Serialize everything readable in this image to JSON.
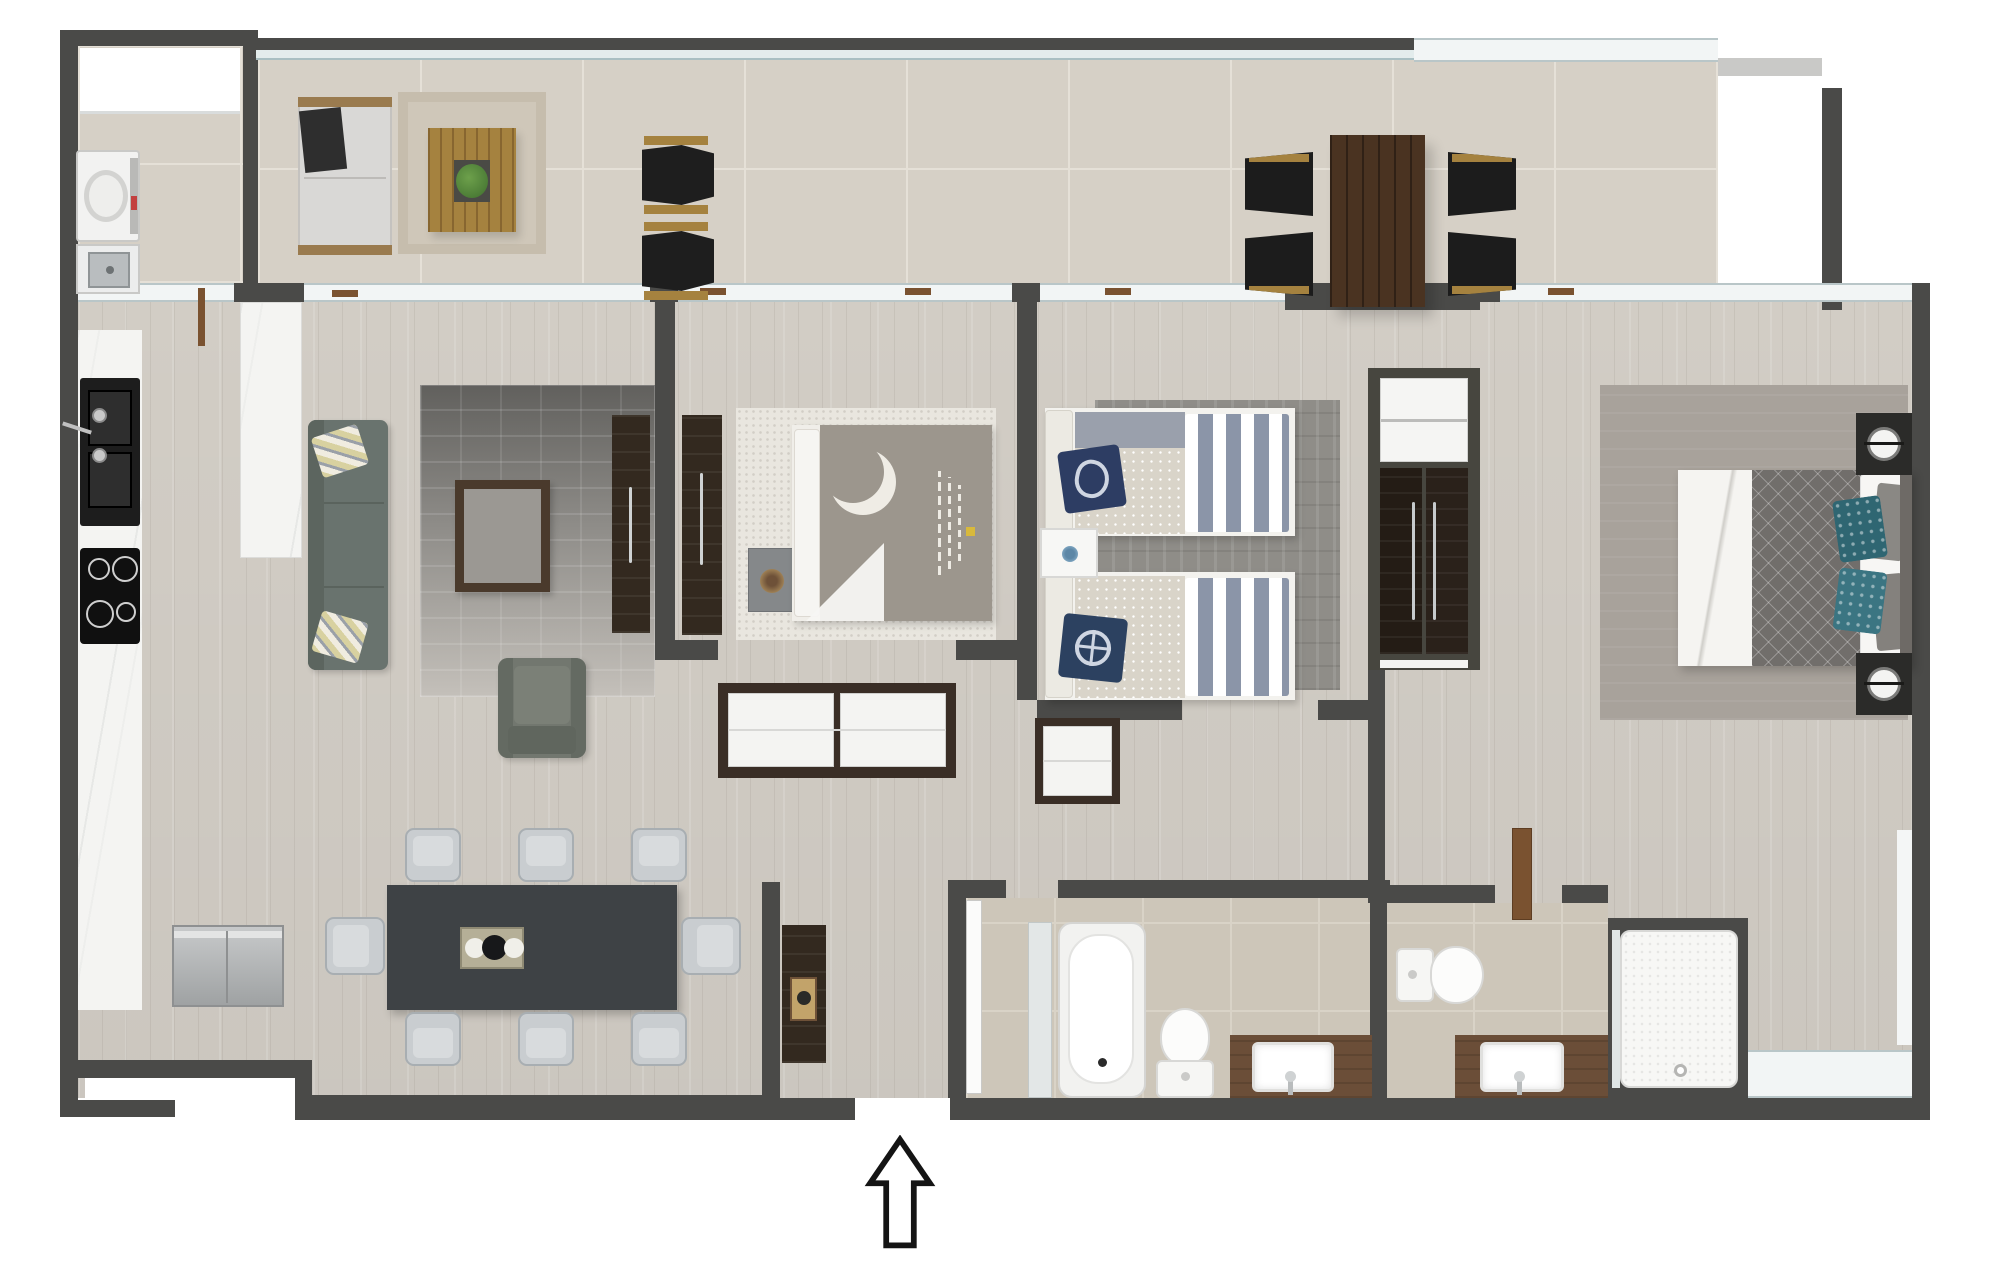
{
  "meta": {
    "title": "Apartment floor plan",
    "description": "Top-down rendered architectural floor plan with furnished rooms, no text labels",
    "entry_arrow_direction": "up"
  },
  "palette": {
    "wall": "#4a4a48",
    "wood_floor": "#d6d1c9",
    "terrace_tile": "#d6d0c6",
    "bathroom_tile": "#cdc6b9",
    "marble": "#f4f4f2",
    "glass": "#f2f5f5",
    "dark_wood": "#33291f",
    "vanity_wood": "#6b4e38",
    "sofa_green_grey": "#69736e",
    "dining_table": "#3e4245",
    "outdoor_wood": "#a5823f",
    "outdoor_table": "#4a3321",
    "navy_pillow": "#2d3d63",
    "stripe_blue": "#8b95a8",
    "teal_pillow": "#2f6672",
    "rug_grey": "#8f8d88"
  },
  "rooms": [
    {
      "id": "terrace",
      "label": "Terrace / balcony"
    },
    {
      "id": "laundry",
      "label": "Laundry room"
    },
    {
      "id": "kitchen",
      "label": "Kitchen"
    },
    {
      "id": "living",
      "label": "Living room"
    },
    {
      "id": "dining",
      "label": "Dining area"
    },
    {
      "id": "bedroom1",
      "label": "Bedroom 1"
    },
    {
      "id": "kids_bedroom",
      "label": "Twin bedroom"
    },
    {
      "id": "closet",
      "label": "Built-in closet"
    },
    {
      "id": "hallway",
      "label": "Hallway"
    },
    {
      "id": "entry",
      "label": "Entry"
    },
    {
      "id": "bathroom",
      "label": "Family bathroom"
    },
    {
      "id": "ensuite",
      "label": "En-suite bathroom"
    },
    {
      "id": "master",
      "label": "Master bedroom"
    }
  ],
  "furniture": {
    "terrace": [
      "outdoor-sofa",
      "outdoor-rug",
      "outdoor-coffee-table",
      "planter",
      "lounge-chair x2",
      "outdoor-dining-table",
      "outdoor-chair x4"
    ],
    "laundry": [
      "washing-machine",
      "utility-sink"
    ],
    "kitchen": [
      "counter-with-sink",
      "cooktop-4-burners",
      "island-counter",
      "refrigerator"
    ],
    "living": [
      "sofa-3-seat",
      "accent-pillow x2",
      "gradient-rug",
      "coffee-table",
      "armchair",
      "tv-cabinet"
    ],
    "dining": [
      "dining-table",
      "dining-chair x8",
      "centerpiece-tray"
    ],
    "bedroom1": [
      "double-bed-moon-duvet",
      "wardrobe-panel",
      "nightstand",
      "area-rug",
      "dresser"
    ],
    "kids_bedroom": [
      "twin-bed x2",
      "striped-bedding",
      "nautical-pillow x2",
      "shared-nightstand",
      "area-rug",
      "hall-cabinet"
    ],
    "closet": [
      "shelf-unit",
      "wardrobe-doors x2"
    ],
    "entry": [
      "console-table",
      "entry-arrow"
    ],
    "bathroom": [
      "bathtub",
      "toilet",
      "wood-vanity-with-sink",
      "door-leaf",
      "glass-screen"
    ],
    "ensuite": [
      "toilet",
      "wood-vanity-with-sink",
      "walk-in-shower",
      "door-leaf"
    ],
    "master": [
      "queen-bed",
      "teal-accent-pillow x2",
      "nightstand-with-lamp x2",
      "area-rug"
    ]
  }
}
